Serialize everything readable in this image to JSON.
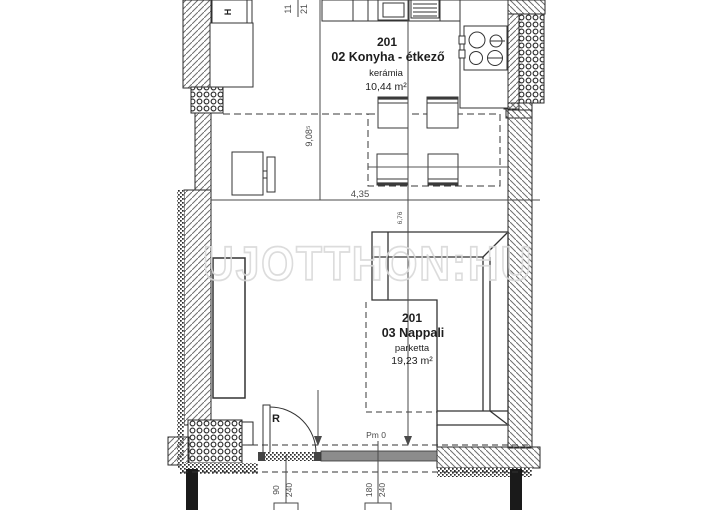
{
  "watermark": {
    "text": "UJOTTHON:HU"
  },
  "plan": {
    "kitchen": {
      "number": "201",
      "label": "02 Konyha - étkező",
      "floor": "kerámia",
      "area": "10,44 m²"
    },
    "living": {
      "number": "201",
      "label": "03 Nappali",
      "floor": "parketta",
      "area": "19,23 m²"
    },
    "fridge_label": "H",
    "door_label": "R",
    "level_mark": "Pm 0"
  },
  "dimensions": {
    "horizontal_chain": "4,35",
    "vertical_chain": "9,08⁵",
    "right_small": "6,76",
    "top_fraction_num": "11",
    "top_fraction_den": "21",
    "door_width": "90",
    "door_height": "240",
    "window_width": "180",
    "window_height": "240"
  },
  "colors": {
    "line": "#333333",
    "dim_text": "#4a4a4a",
    "watermark": "#d9d9d9",
    "window_fill": "#8c8c8c",
    "post_fill": "#1a1a1a"
  }
}
